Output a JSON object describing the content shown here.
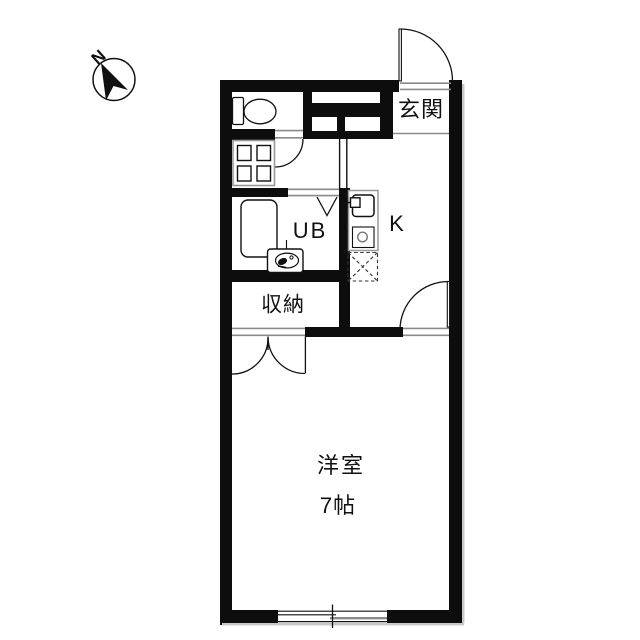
{
  "title": "floor-plan",
  "compass": {
    "north_label": "N"
  },
  "labels": {
    "entrance": "玄関",
    "unit_bath": "UB",
    "kitchen": "K",
    "storage": "収納",
    "main_room": "洋室",
    "main_room_size": "7帖"
  },
  "colors": {
    "wall": "#0d0d0d",
    "background": "#ffffff",
    "thin_line": "#8a8a8a"
  }
}
